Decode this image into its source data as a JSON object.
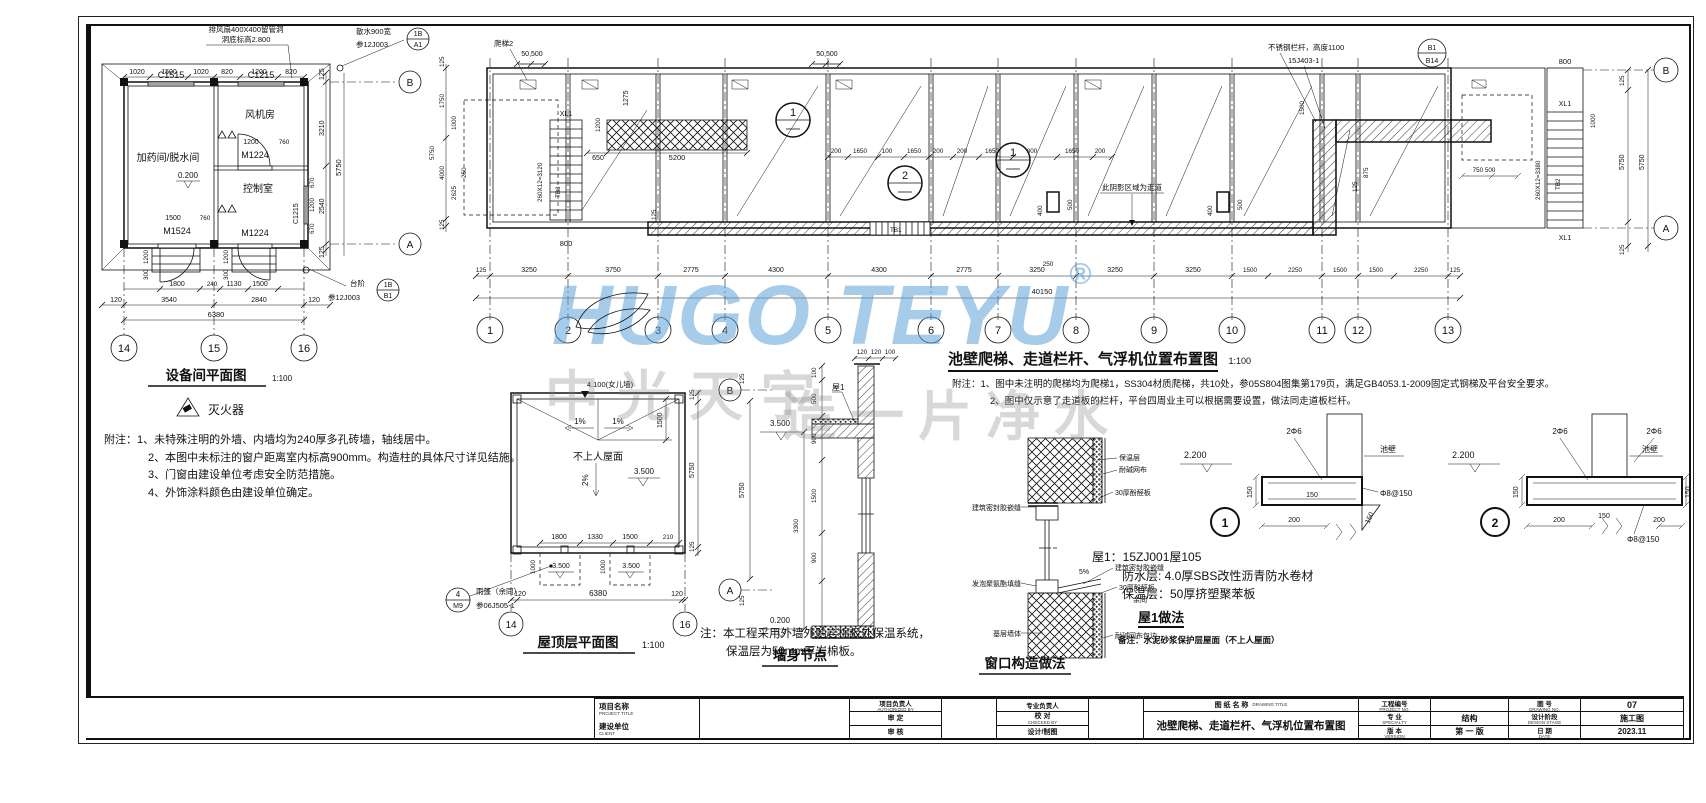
{
  "watermark": {
    "brand": "HUGO TEYU",
    "reg": "®",
    "slogan_left": "中光天宇",
    "slogan_right": "造一片净水"
  },
  "equipment_plan": {
    "title": "设备间平面图",
    "scale": "1:100",
    "callout_fan_line1": "排风扇400X400留管洞",
    "callout_fan_line2": "洞底标高2.800",
    "callout_sanshui_line1": "散水900宽",
    "callout_sanshui_line2": "参12J003",
    "sanshui_bubble_top": "1B",
    "sanshui_bubble_bottom": "A1",
    "callout_taijie_label": "台阶",
    "callout_taijie_ref": "参12J003",
    "taijie_bubble_top": "1B",
    "taijie_bubble_bottom": "B1",
    "window_c1515": "C1515",
    "window_c1215_top": "C1215",
    "window_c1215_right": "C1215",
    "room_dosing": "加药间/脱水间",
    "room_fan": "风机房",
    "room_control": "控制室",
    "door_m1524": "M1524",
    "door_m1224_inner": "M1224",
    "door_m1224_bottom": "M1224",
    "elevation": "0.200",
    "dims_top": [
      "1020",
      "1500",
      "1020",
      "820",
      "1200",
      "820"
    ],
    "dims_right": [
      "125",
      "3210",
      "2540",
      "125"
    ],
    "dim_right_total": "5750",
    "dims_right_window": [
      "670",
      "1200",
      "670"
    ],
    "dims_door_inner": [
      "1200",
      "760"
    ],
    "dims_door_bottom": [
      "1500",
      "760"
    ],
    "dims_steps": [
      "1200",
      "300"
    ],
    "dims_bottom_row1": [
      "1800",
      "240",
      "1130",
      "1500"
    ],
    "dims_bottom_row2": [
      "120",
      "3540",
      "2840",
      "120"
    ],
    "dim_bottom_total": "6380",
    "grid_b": "B",
    "grid_a": "A",
    "grids": [
      "14",
      "15",
      "16"
    ],
    "legend_extinguisher": "灭火器"
  },
  "equipment_notes": {
    "n1": "附注：1、未特殊注明的外墙、内墙均为240厚多孔砖墙，轴线居中。",
    "n2": "2、本图中未标注的窗户距离室内标高900mm。构造柱的具体尺寸详见结施。",
    "n3": "3、门窗由建设单位考虑安全防范措施。",
    "n4": "4、外饰涂料颜色由建设单位确定。"
  },
  "main_plan": {
    "title": "池壁爬梯、走道栏杆、气浮机位置布置图",
    "scale": "1:100",
    "note1": "附注：1、图中未注明的爬梯均为爬梯1，SS304材质爬梯，共10处，参05S804图集第179页，满足GB4053.1-2009固定式钢梯及平台安全要求。",
    "note2": "2、图中仅示意了走道板的栏杆，平台四周业主可以根据需要设置，做法同走道板栏杆。",
    "grids": [
      "1",
      "2",
      "3",
      "4",
      "5",
      "6",
      "7",
      "8",
      "9",
      "10",
      "11",
      "12",
      "13"
    ],
    "grid_b": "B",
    "grid_a": "A",
    "dims_bottom": [
      "125",
      "3250",
      "3750",
      "2775",
      "4300",
      "4300",
      "2775",
      "3250",
      "3250",
      "3250",
      "1500",
      "2250",
      "1500",
      "1500",
      "2250",
      "125"
    ],
    "dim_total": "40150",
    "dims_left": [
      "125",
      "1750",
      "1000",
      "4000",
      "2625",
      "250",
      "5750",
      "125"
    ],
    "dims_right": [
      "125",
      "800",
      "1000",
      "5750",
      "5750",
      "125"
    ],
    "ladder2": "爬梯2",
    "xl1": "XL1",
    "tb1": "TB1",
    "tb2": "TB2",
    "tb3": "TB3",
    "stair_note_left": "260X12=3120",
    "stair_note_right": "260X12=3380",
    "walkway_label": "此阴影区域为走道",
    "dim_50500": "50,500",
    "dim_1275": "1275",
    "dim_1200": "1200",
    "dim_650": "650",
    "dim_5200": "5200",
    "dim_800": "800",
    "dims_mid": [
      "200",
      "1650",
      "100",
      "1650",
      "200",
      "200",
      "1650",
      "300",
      "1650",
      "200"
    ],
    "dim_1500": "1500",
    "dim_500": "500",
    "dim_400": "400",
    "dim_875": "875",
    "dim_125": "125",
    "dim_250": "250",
    "dims_750_500": "750 500",
    "railing_callout_line1": "不锈钢栏杆，高度1100",
    "railing_callout_line2": "15J403-1",
    "railing_bubble_top": "B1",
    "railing_bubble_bottom": "B14",
    "machine_1": "1",
    "machine_2": "2"
  },
  "roof_plan": {
    "title": "屋顶层平面图",
    "scale": "1:100",
    "parapet": "4.100(女儿墙)",
    "roof_label": "不上人屋面",
    "slope_left": "1%",
    "slope_right": "1%",
    "slope_down": "2%",
    "elev_main": "3.500",
    "elev_canopy1": "3.500",
    "elev_canopy2": "3.500",
    "dim_1500": "1500",
    "dims_inner": [
      "1800",
      "1330",
      "1500",
      "210"
    ],
    "dim_1000": "1000",
    "dims_bottom": [
      "120",
      "6380",
      "120"
    ],
    "dims_right": [
      "125",
      "5750",
      "125"
    ],
    "canopy_bubble_top": "4",
    "canopy_bubble_bottom": "M9",
    "canopy_label": "雨篷（余同）",
    "canopy_ref": "参06J505-1",
    "grids": [
      "14",
      "16"
    ]
  },
  "wall_section": {
    "title": "墙身节点",
    "grid_b": "B",
    "grid_a": "A",
    "dims_grid": [
      "125",
      "5750",
      "125"
    ],
    "elev_top": "3.500",
    "elev_bottom": "0.200",
    "dims_v": [
      "100",
      "500",
      "900",
      "1500",
      "900"
    ],
    "dim_total": "3300",
    "dims_top": [
      "120",
      "120",
      "100"
    ],
    "roof_tag": "屋1",
    "note1": "注：本工程采用外墙外贴岩棉板外保温系统，",
    "note2": "保温层为50mm厚岩棉板。"
  },
  "window_detail": {
    "title": "窗口构造做法",
    "label_sealant_top": "建筑密封胶嵌缝",
    "label_foam": "发泡聚氨酯填缝",
    "label_base_wall": "基层墙体",
    "label_insulation": "保温层",
    "label_mesh": "耐碱网布",
    "label_board_top": "30厚酚醛板",
    "label_slope": "5%",
    "label_sealant_sill": "建筑密封胶嵌缝",
    "label_board_sill": "30厚酚醛板",
    "label_rest": "余同",
    "label_mesh_wrap": "耐碱网布包边"
  },
  "roof1_spec": {
    "line1": "屋1：15ZJ001屋105",
    "line2": "防水层: 4.0厚SBS改性沥青防水卷材",
    "line3": "保温层：50厚挤塑聚苯板",
    "title": "屋1做法",
    "remark": "备注：水泥砂浆保护层屋面（不上人屋面）"
  },
  "details": {
    "d1": {
      "num": "1",
      "elev": "2.200",
      "rebar_top": "2Φ6",
      "wall": "池壁",
      "rebar_bottom": "Φ8@150",
      "dim_150a": "150",
      "dim_150b": "150",
      "dim_150c": "150",
      "dim_200": "200"
    },
    "d2": {
      "num": "2",
      "elev": "2.200",
      "rebar_left": "2Φ6",
      "rebar_right": "2Φ6",
      "wall": "池壁",
      "rebar_bottom": "Φ8@150",
      "dim_150a": "150",
      "dim_150b": "150",
      "dim_150c": "150",
      "dim_200a": "200",
      "dim_200b": "200"
    }
  },
  "titleblock": {
    "project_label": "项目名称",
    "project_label_en": "PROJECT TITLE",
    "client_label": "建设单位",
    "client_label_en": "CLIENT",
    "authorized_label": "项目负责人",
    "authorized_label_en": "AUTHORIZED BY",
    "approved_label": "审 定",
    "reviewed_label": "审 核",
    "discipline_lead_label": "专业负责人",
    "proof_label": "校 对",
    "proof_label_en": "CHECKED BY",
    "design_draft_label": "设计/制图",
    "drawing_title_label": "图 纸 名 称",
    "drawing_title_label_en": "DRAWING TITLE",
    "drawing_title": "池壁爬梯、走道栏杆、气浮机位置布置图",
    "project_no_label": "工程编号",
    "project_no_label_en": "PROJECT NO.",
    "specialty_label": "专 业",
    "specialty_label_en": "SPECIALTY",
    "specialty_value": "结构",
    "version_label": "版 本",
    "version_label_en": "VERSION",
    "version_value": "第 一 版",
    "drawing_no_label": "图 号",
    "drawing_no_label_en": "DRAWING NO.",
    "drawing_no_value": "07",
    "stage_label": "设计阶段",
    "stage_label_en": "DESIGN STAGE",
    "stage_value": "施工图",
    "date_label": "日 期",
    "date_label_en": "DATE",
    "date_value": "2023.11"
  }
}
